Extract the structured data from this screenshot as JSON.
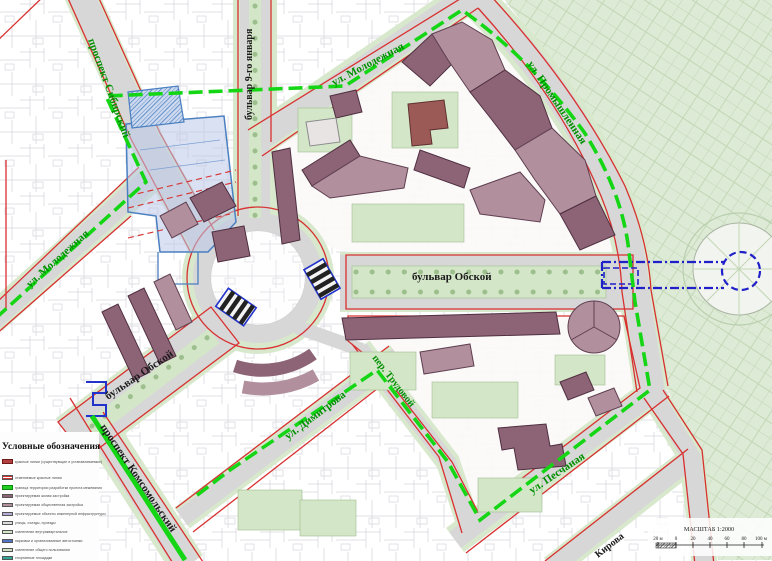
{
  "map": {
    "labels": {
      "sibirsky": "проспект Сибирский",
      "molodezhnaya_left": "ул. Молодежная",
      "boulevard_9": "бульвар 9-го января",
      "molodezhnaya_top": "ул. Молодежная",
      "promyshlennaya": "ул. Промышленная",
      "obskoy_right": "бульвар Обской",
      "obskoy_left": "бульвар Обской",
      "komsomolsky": "проспект Комсомольский",
      "dimitrova": "ул. Димитрова",
      "trudovoy": "пер. Трудовой",
      "peschanaya": "ул. Песчаная",
      "kirova": "Кирова"
    }
  },
  "legend": {
    "title": "Условные обозначения",
    "items": [
      {
        "label": "красные линии (существующие и устанавливаемые)",
        "color": "#b24040"
      },
      {
        "label": "отменяемые красные линии",
        "color": "#d03030"
      },
      {
        "label": "граница территории разработки проекта межевания",
        "color": "#22cc22"
      },
      {
        "label": "проектируемая жилая застройка",
        "color": "#8d6376"
      },
      {
        "label": "проектируемая общественная застройка",
        "color": "#b18f9d"
      },
      {
        "label": "проектируемые объекты инженерной инфраструктуры",
        "color": "#b6abd4"
      },
      {
        "label": "улицы, съезды, проезды",
        "color": "#dcdcdc"
      },
      {
        "label": "озеленение внутриквартальное",
        "color": "#d4e6c8"
      },
      {
        "label": "парковки и организованные автостоянки",
        "color": "#4f74c8"
      },
      {
        "label": "озеленение общего пользования",
        "color": "#cfe2c4"
      },
      {
        "label": "спортивные площадки",
        "color": "#2fa898"
      }
    ]
  },
  "scalebar": {
    "title": "МАСШТАБ 1:2000",
    "ticks": [
      "20 м",
      "0",
      "20",
      "40",
      "60",
      "80",
      "100 м"
    ]
  },
  "colors": {
    "red_line": "#d83030",
    "boundary_green": "#15d615",
    "street_label_green": "#008f00",
    "road_gray": "#d7d7d7",
    "park_green": "#dcead6",
    "courtyard_green": "#d4e6c8",
    "building_residential": "#8d6376",
    "building_public": "#b18f9d",
    "engineering_lavender": "#b6abd4",
    "zone_blue": "#2f6fc4",
    "corridor_blue": "#2020c8"
  }
}
